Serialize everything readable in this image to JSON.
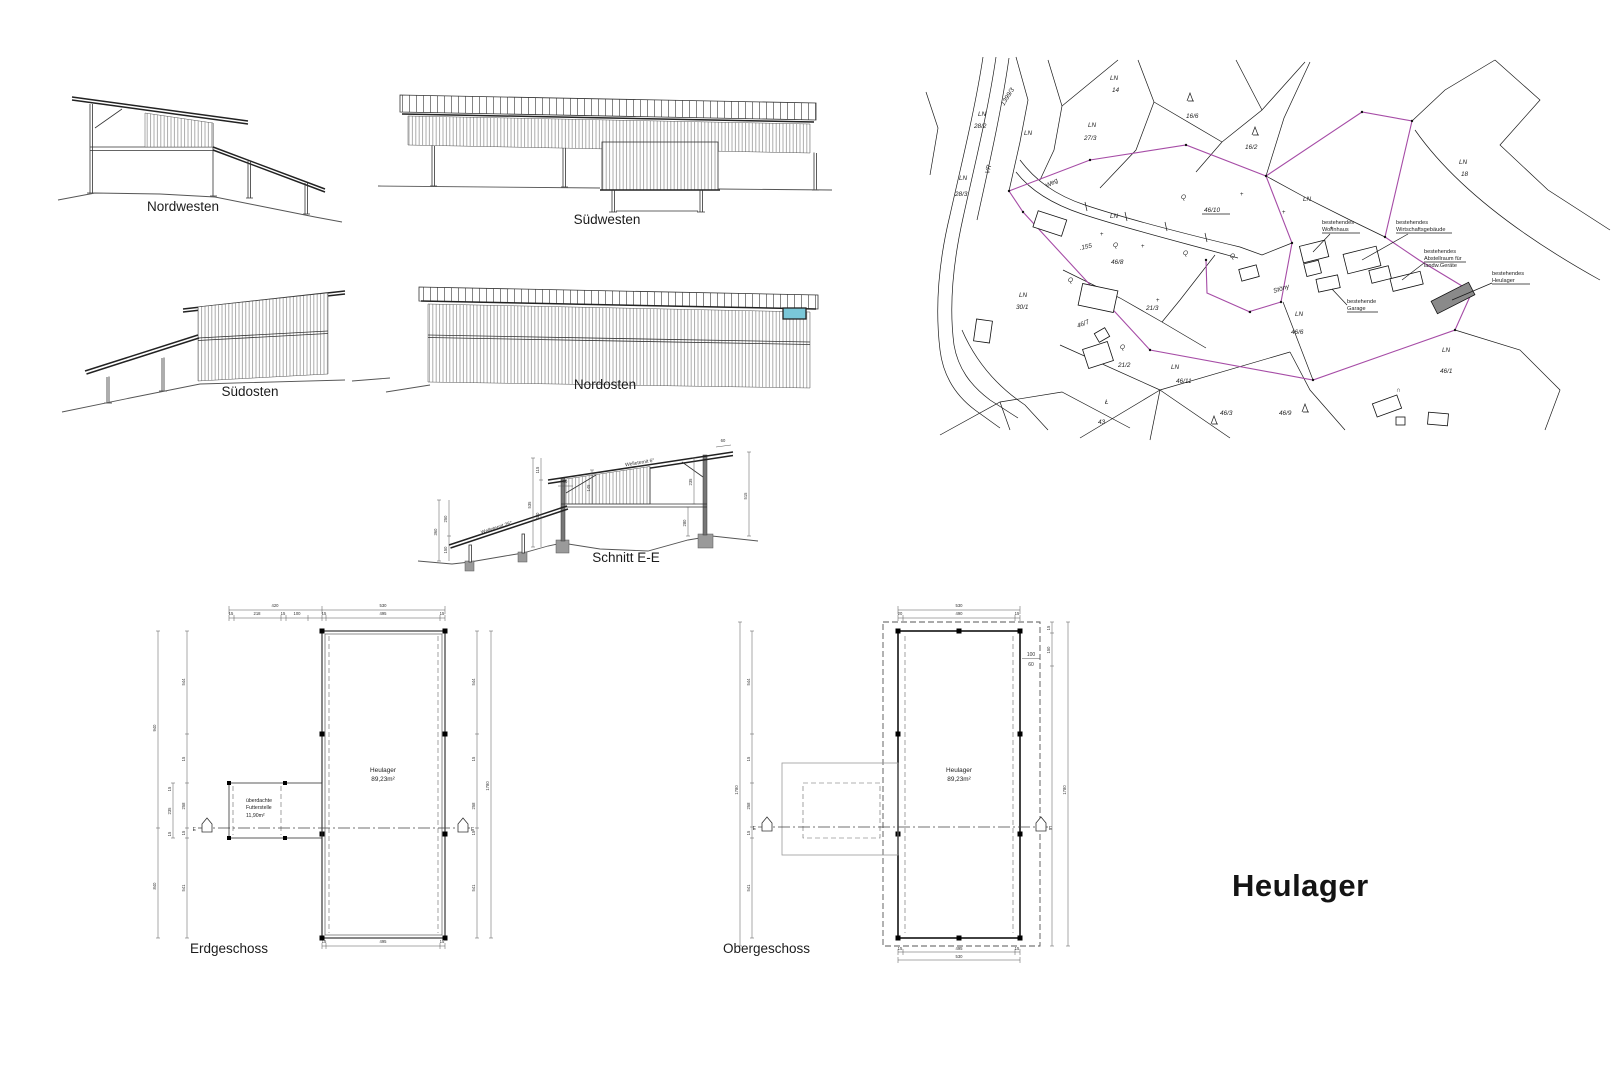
{
  "sheet": {
    "title": "Heulager"
  },
  "elevations": {
    "nordwesten": {
      "label": "Nordwesten"
    },
    "suedwesten": {
      "label": "Südwesten"
    },
    "suedosten": {
      "label": "Südosten"
    },
    "nordosten": {
      "label": "Nordosten",
      "window_color": "#7ac7d8"
    }
  },
  "section": {
    "label": "Schnitt E-E",
    "roof_upper_note": "Welleternit 6°",
    "roof_lower_note": "Welleternit 26°",
    "dims": {
      "overhang_left": "80",
      "overhang_right": "60",
      "top_offset": "115",
      "clad": "145",
      "lean_lower": "150",
      "frame": "235",
      "lean_upper": "250",
      "wall": "280",
      "lean_total": "360",
      "mid_inner": "480",
      "right_total": "515",
      "mid_total": "535"
    }
  },
  "plans": {
    "erdgeschoss": {
      "label": "Erdgeschoss",
      "room": {
        "name": "Heulager",
        "area": "89,23m²"
      },
      "annex": {
        "line1": "überdachte",
        "line2": "Futterstelle",
        "line3": "11,90m²"
      },
      "marker": "E",
      "dims": {
        "top1": [
          "420",
          "530"
        ],
        "top2": [
          "15",
          "218",
          "15",
          "100",
          "15",
          "495",
          "15"
        ],
        "bottom": [
          "15",
          "495",
          "15"
        ],
        "left_outer": [
          "940",
          "840"
        ],
        "left_inner": [
          "544",
          "15",
          "258",
          "15",
          "541"
        ],
        "annex_side": [
          "15",
          "235",
          "15"
        ],
        "right_inner": [
          "544",
          "15",
          "258",
          "15",
          "541"
        ],
        "right_total": "1780"
      }
    },
    "obergeschoss": {
      "label": "Obergeschoss",
      "room": {
        "name": "Heulager",
        "area": "89,23m²"
      },
      "marker": "E",
      "window_note": {
        "top": "100",
        "bottom": "60"
      },
      "dims": {
        "top1": "530",
        "top2": [
          "20",
          "490",
          "15"
        ],
        "bottom": [
          "15",
          "495",
          "15"
        ],
        "bottom2": "530",
        "left_total": "1780",
        "left_inner": [
          "544",
          "15",
          "258",
          "15",
          "541"
        ],
        "right_upper": [
          "15",
          "150"
        ],
        "right_total": "1780"
      }
    }
  },
  "siteplan": {
    "boundary_color": "#a64ca6",
    "existing_building_fill": "#8a8a8a",
    "area_labels": [
      {
        "l1": "LN",
        "l2": "28/2"
      },
      {
        "l1": "1399/3"
      },
      {
        "l1": "LN"
      },
      {
        "l1": "VR"
      },
      {
        "l1": "LN",
        "l2": "28/3"
      },
      {
        "l1": "LN",
        "l2": "14"
      },
      {
        "l1": "LN",
        "l2": "27/3"
      },
      {
        "l1": "Weg"
      },
      {
        "l1": "LN"
      },
      {
        "l1": ".155"
      },
      {
        "l1": "Q",
        "l2": "46/8"
      },
      {
        "l1": "Q"
      },
      {
        "l1": "Q"
      },
      {
        "l1": "Q",
        "l2": "46/10"
      },
      {
        "l1": "LN"
      },
      {
        "l1": "16/6"
      },
      {
        "l1": "16/2"
      },
      {
        "l1": "LN",
        "l2": "18"
      },
      {
        "l1": "LN",
        "l2": "30/1"
      },
      {
        "l1": "46/7"
      },
      {
        "l1": "Q"
      },
      {
        "l1": "21/3"
      },
      {
        "l1": "Q",
        "l2": "21/2"
      },
      {
        "l1": "LN",
        "l2": "46/11"
      },
      {
        "l1": "Ł",
        "l2": "43"
      },
      {
        "l1": "46/3"
      },
      {
        "l1": "46/9"
      },
      {
        "l1": "LN",
        "l2": "46/1"
      },
      {
        "l1": "LN",
        "l2": "46/6"
      },
      {
        "l1": "Stöny"
      }
    ],
    "annotations": [
      {
        "l1": "bestehendes",
        "l2": "Wohnhaus"
      },
      {
        "l1": "bestehendes",
        "l2": "Wirtschaftsgebäude"
      },
      {
        "l1": "bestehendes",
        "l2": "Abstellraum für",
        "l3": "landw.Geräte"
      },
      {
        "l1": "bestehende",
        "l2": "Garage"
      },
      {
        "l1": "bestehendes",
        "l2": "Heulager"
      }
    ],
    "symbols": {
      "cave": "∩"
    }
  }
}
